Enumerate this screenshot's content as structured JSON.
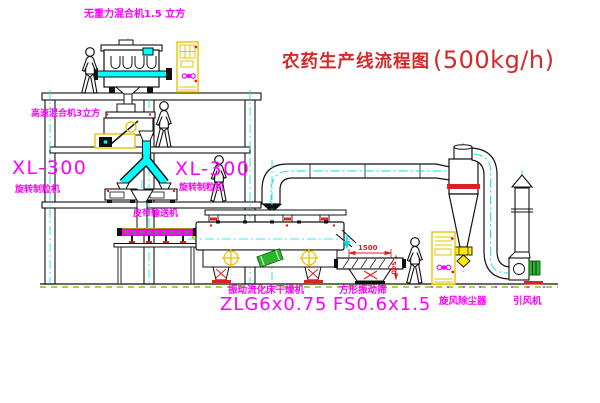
{
  "title": {
    "cn": "农药生产线流程图",
    "capacity": "(500kg/h)"
  },
  "labels": {
    "mixer1": "无重力混合机1.5 立方",
    "mixer2": "高速混合机3立方",
    "xl300_left": "XL-300",
    "granulator_left": "旋转制粒机",
    "xl300_right": "XL-300",
    "granulator_right": "旋转制粒机",
    "conveyor": "皮带输送机",
    "dryer": "振动流化床干燥机",
    "dryer_model": "ZLG6x0.75",
    "sieve": "方形振动筛",
    "sieve_model": "FS0.6x1.5",
    "cyclone": "旋风除尘器",
    "fan": "引风机"
  },
  "dimensions": {
    "dim_1500": "1500",
    "dim_540": "540"
  },
  "colors": {
    "label_magenta": "#ff00ff",
    "title_red": "#d42a2a",
    "pipe_cyan": "#00ffff",
    "equipment_yellow": "#e6c400",
    "accent_green": "#22bb22",
    "mark_red": "#ff0000"
  }
}
